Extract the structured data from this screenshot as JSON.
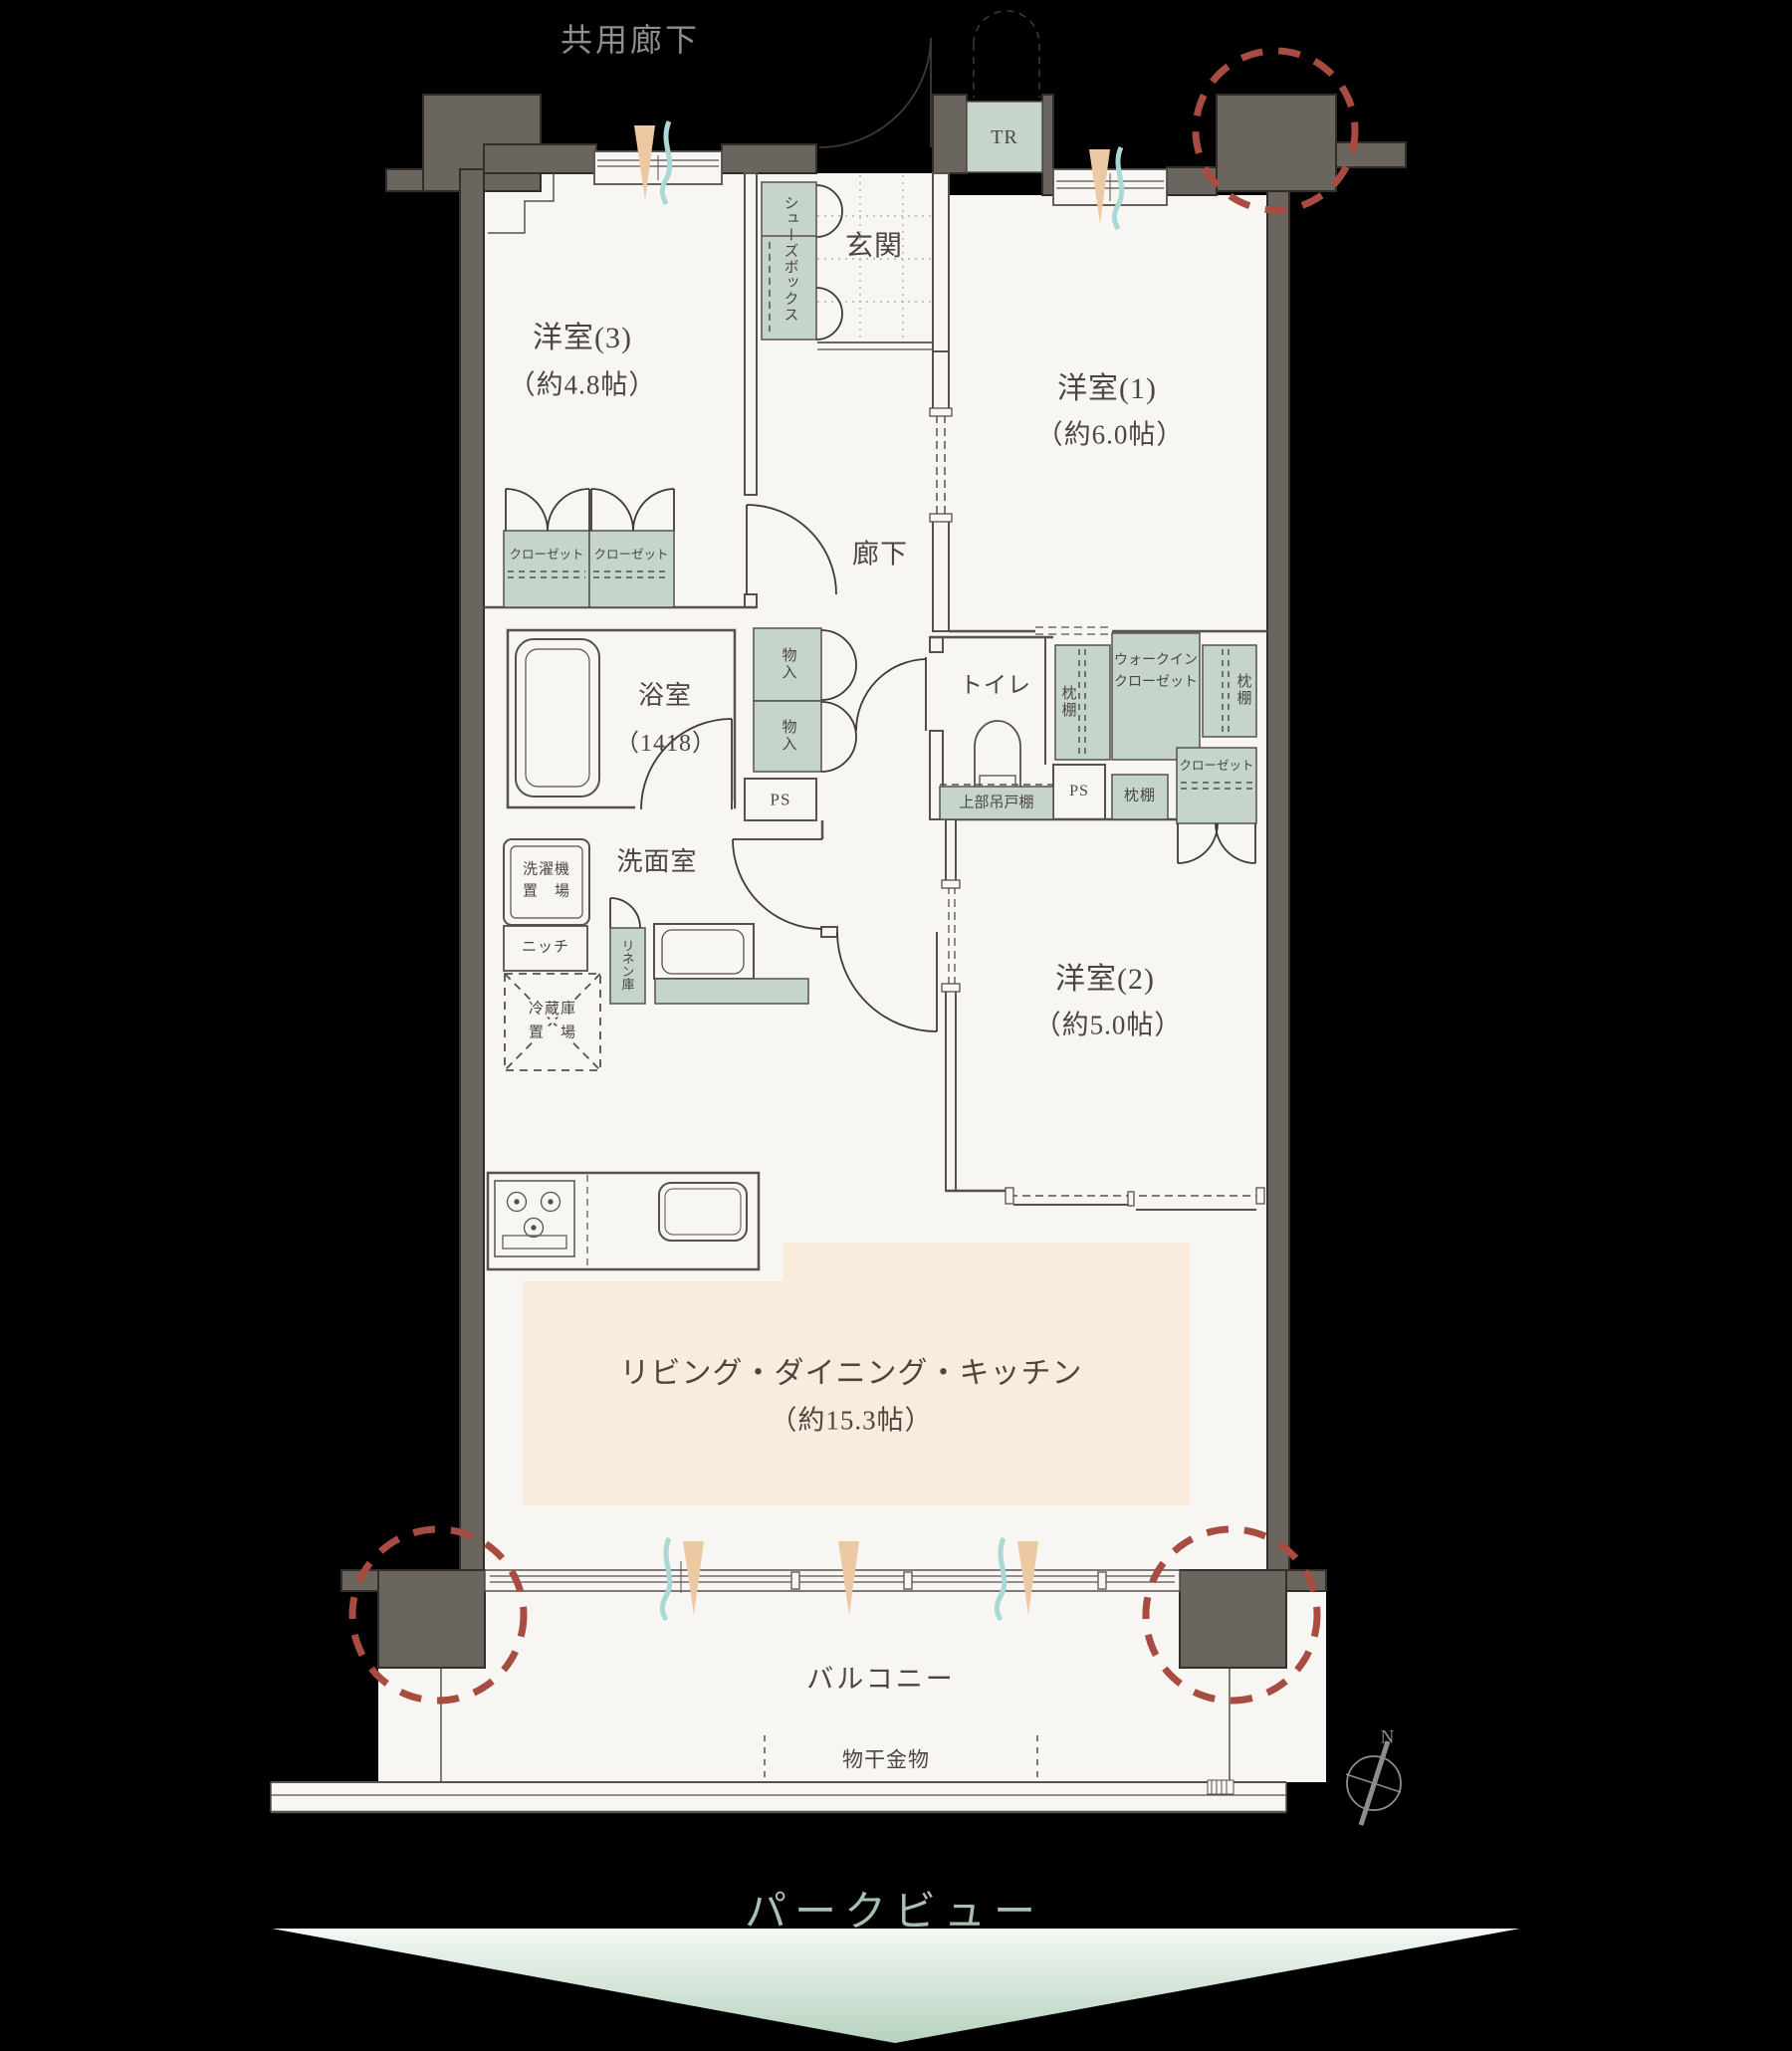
{
  "labels": {
    "commonCorridor": "共用廊下",
    "room3": "洋室(3)",
    "room3Size": "（約4.8帖）",
    "room1": "洋室(1)",
    "room1Size": "（約6.0帖）",
    "room2": "洋室(2)",
    "room2Size": "（約5.0帖）",
    "ldk": "リビング・ダイニング・キッチン",
    "ldkSize": "（約15.3帖）",
    "genkan": "玄関",
    "shoesBox": "シューズボックス",
    "tr": "TR",
    "corridor": "廊下",
    "closet1": "クローゼット",
    "closet2": "クローゼット",
    "bath": "浴室",
    "bathSize": "（1418）",
    "storage1": "物入",
    "storage2": "物入",
    "ps1": "PS",
    "toilet": "トイレ",
    "upperCabinet": "上部吊戸棚",
    "pillowShelfL": "枕棚",
    "wic1": "ウォークイン",
    "wic2": "クローゼット",
    "pillowShelfR": "枕棚",
    "ps2": "PS",
    "pillowShelfB": "枕棚",
    "wicCloset": "クローゼット",
    "washroom": "洗面室",
    "laundry1": "洗濯機",
    "laundry2": "置　場",
    "niche": "ニッチ",
    "linen": "リネン庫",
    "fridge1": "冷蔵庫",
    "fridge2": "置　場",
    "balcony": "バルコニー",
    "laundryHardware": "物干金物",
    "north": "N",
    "parkView": "パークビュー"
  },
  "colors": {
    "bg": "#000000",
    "wall": "#6b6560",
    "wallEdge": "#332e2a",
    "floor": "#f7f6f3",
    "line": "#57514d",
    "ink": "#4c4640",
    "muted": "#8d8d8d",
    "green": "#c6d5cb",
    "peach": "#f9ecdc",
    "red": "#a84c41",
    "teal": "#a9d8d5",
    "cone": "#ecc9a2",
    "park": "#a6c2af"
  }
}
